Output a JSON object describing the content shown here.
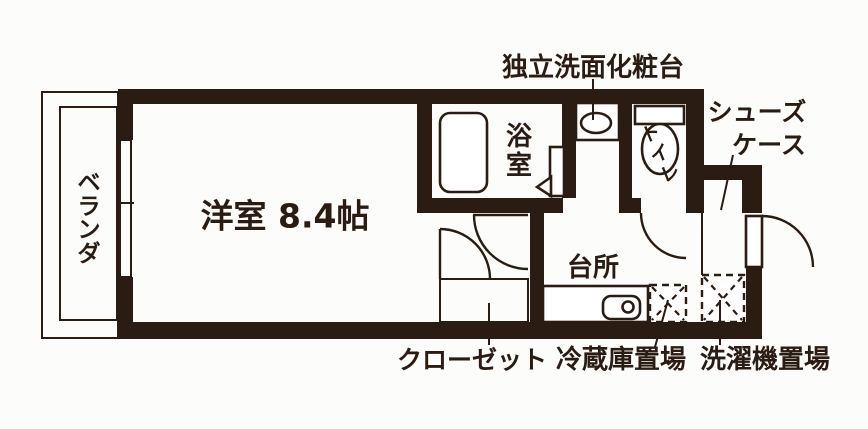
{
  "floor_plan": {
    "title": "ワンルーム間取り図",
    "colors": {
      "ink": "#2a1c13",
      "background": "#fcfcfa",
      "fixture_fill": "#ffffff"
    },
    "labels": {
      "western_room": "洋室 8.4帖",
      "kitchen": "台所",
      "vanity": "独立洗面化粧台",
      "shoe_case_line1": "シューズ",
      "shoe_case_line2": "ケース",
      "closet": "クローゼット",
      "refrigerator_space": "冷蔵庫置場",
      "washing_machine_space": "洗濯機置場",
      "veranda": "ベランダ",
      "veranda_chars": [
        "ベ",
        "ラ",
        "ン",
        "ダ"
      ],
      "bathroom": "浴室",
      "bathroom_chars": [
        "浴",
        "室"
      ],
      "toilet": "トイレ",
      "toilet_chars": [
        "ト",
        "イ",
        "レ"
      ]
    }
  }
}
